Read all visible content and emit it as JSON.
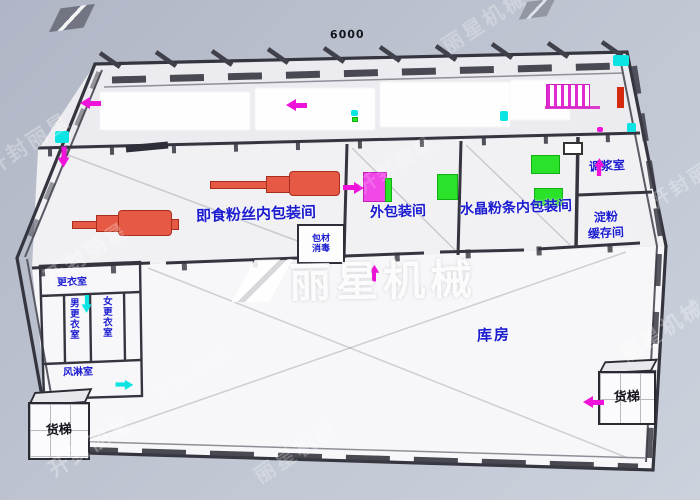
{
  "scene": {
    "type": "factory-floor-plan-3d",
    "dimension_label": "6000"
  },
  "colors": {
    "background_top": "#b2b8c7",
    "background_bottom": "#ccd2dc",
    "wall": "#35353f",
    "floor": "#f4f4f7",
    "label_blue": "#1b1bd0",
    "machine_red": "#e65a45",
    "accent_green": "#2ae22a",
    "accent_magenta": "#ef12d9",
    "accent_cyan": "#0ce4e4",
    "red_bar": "#d52a10"
  },
  "rooms": {
    "instant_vermicelli_inner_packing": "即食粉丝内包装间",
    "outer_packing": "外包装间",
    "crystal_vermicelli_inner_packing": "水晶粉条内包装间",
    "slurry_mixing": "调浆室",
    "starch_buffer": {
      "line1": "淀粉",
      "line2": "缓存间"
    },
    "warehouse": "库房",
    "packing_material": {
      "line1": "包材",
      "line2": "消毒"
    },
    "freight_elevator_left": "货梯",
    "freight_elevator_right": "货梯",
    "dressing_room": "更衣室",
    "men_corridor": "男更衣室",
    "women_corridor": "女更衣室",
    "air_shower": "风淋室"
  },
  "watermark": {
    "center_text": "丽星机械",
    "tiles": [
      {
        "text": "开封丽星"
      },
      {
        "text": "开封丽星"
      },
      {
        "text": "开封丽星"
      },
      {
        "text": "丽星机械"
      },
      {
        "text": "开封丽星"
      },
      {
        "text": "丽星机械"
      },
      {
        "text": "开封丽星"
      },
      {
        "text": "丽星机械"
      },
      {
        "text": "开封丽星"
      }
    ]
  }
}
